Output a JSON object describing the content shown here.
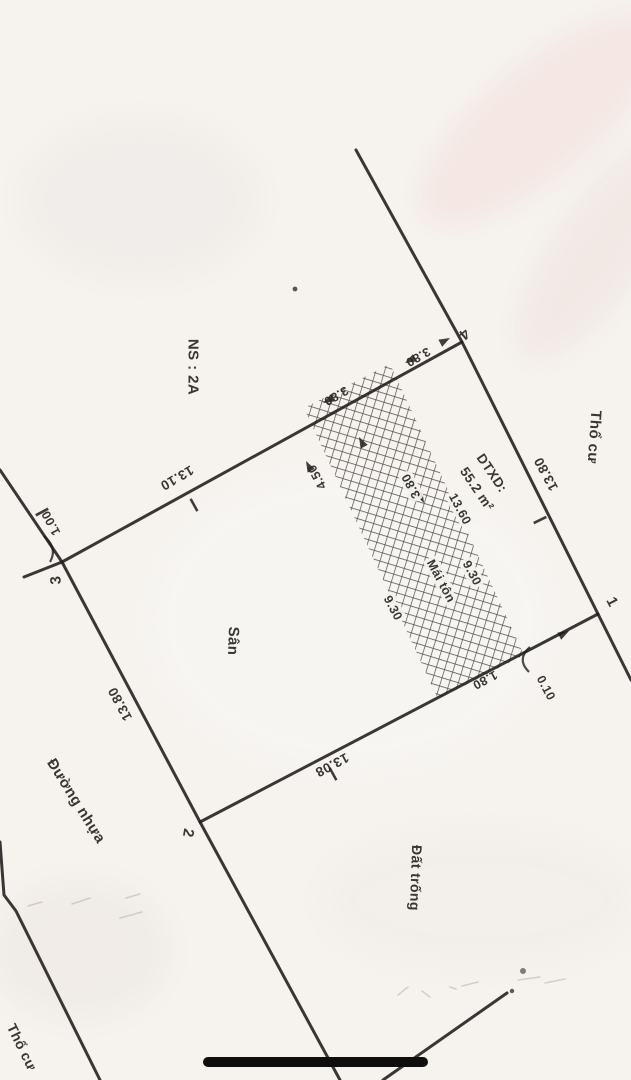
{
  "drawing": {
    "zones": {
      "ns": "NS : 2A",
      "tho_cu": "Thổ cư",
      "tho_cu_partial": "Thổ cư",
      "san": "Sân",
      "dat_trong": "Đất trống",
      "duong_nhua": "Đường nhựa",
      "mai_ton": "Mái tôn"
    },
    "building": {
      "dtxd_label": "DTXD:",
      "dtxd_value": "55.2 m²"
    },
    "corners": {
      "c1": "1",
      "c2": "2",
      "c3": "3",
      "c4": "4"
    },
    "dimensions": {
      "edge_3_4": "13.10",
      "edge_3_2": "13.80",
      "edge_2_1": "13.08",
      "edge_4_1": "13.80",
      "road_offset": "1.00",
      "seg_near_c4": "3.80",
      "seg_strip_left": "3.80",
      "seg_to_c3": "4.50",
      "strip_width": "3.80",
      "strip_length_a": "9.30",
      "strip_length_b": "9.30",
      "strip_length_c": "13.60",
      "end_near_c1": "1.80",
      "end_offset": "0.10"
    }
  }
}
